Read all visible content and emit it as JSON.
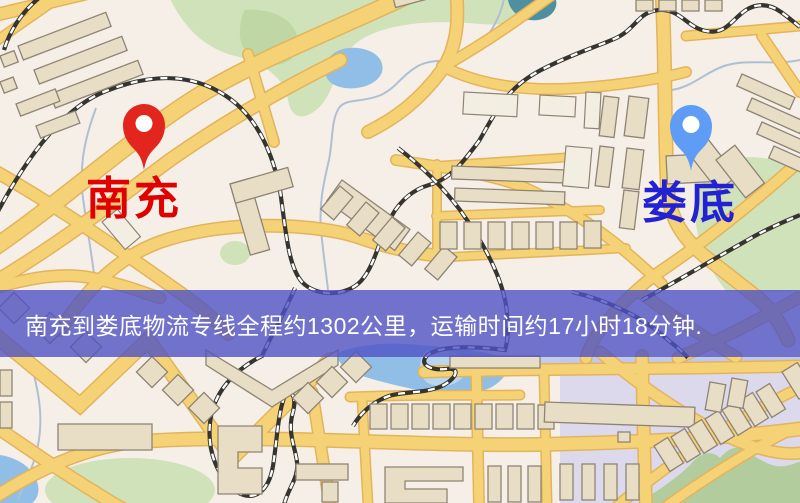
{
  "map": {
    "markers": [
      {
        "city": "南充",
        "role": "origin",
        "pin_color": "#e3261d",
        "label_color": "#e00000"
      },
      {
        "city": "娄底",
        "role": "destination",
        "pin_color": "#5e9cf5",
        "label_color": "#2322d2"
      }
    ],
    "banner": {
      "text": "南充到娄底物流专线全程约1302公里，运输时间约17小时18分钟.",
      "text_color": "#ffffff",
      "background_color": "rgba(79,82,196,0.8)"
    }
  },
  "palette": {
    "map_background": "#f5efe7",
    "road": "#f6d276",
    "road_casing": "#e3b45c",
    "railway_dark": "#35342f",
    "building_fill": "#e8dec6",
    "building_stroke": "#8f8474",
    "park_green": "#cfe2ba",
    "water_blue": "#90bee6",
    "water_lavender": "#d9d6ec"
  }
}
